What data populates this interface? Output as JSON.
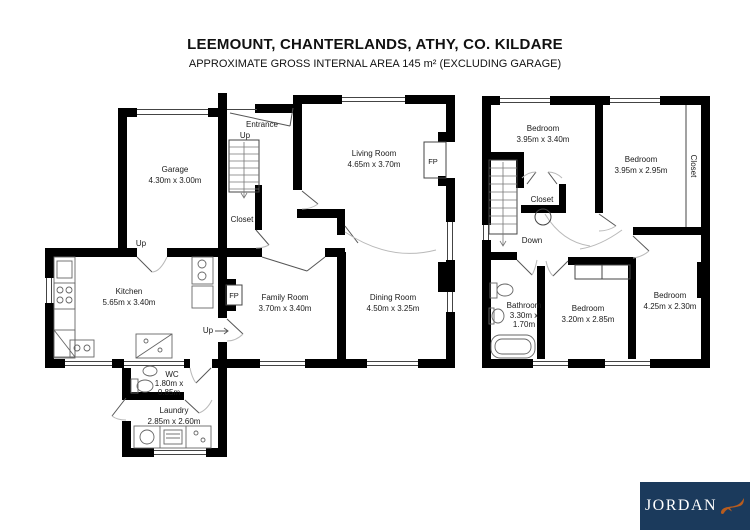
{
  "header": {
    "title": "LEEMOUNT, CHANTERLANDS, ATHY, CO. KILDARE",
    "subtitle": "APPROXIMATE GROSS INTERNAL AREA 145 m² (EXCLUDING GARAGE)"
  },
  "ground_floor": {
    "garage": {
      "name": "Garage",
      "dims": "4.30m x 3.00m"
    },
    "living": {
      "name": "Living Room",
      "dims": "4.65m x 3.70m"
    },
    "kitchen": {
      "name": "Kitchen",
      "dims": "5.65m x 3.40m"
    },
    "family": {
      "name": "Family Room",
      "dims": "3.70m x 3.40m"
    },
    "dining": {
      "name": "Dining Room",
      "dims": "4.50m x 3.25m"
    },
    "wc": {
      "name": "WC",
      "dims_line1": "1.80m x",
      "dims_line2": "0.85m"
    },
    "laundry": {
      "name": "Laundry",
      "dims": "2.85m x 2.60m"
    },
    "entrance_label": "Entrance",
    "up_label": "Up",
    "closet_label": "Closet",
    "fp_label": "FP"
  },
  "first_floor": {
    "bedroom1": {
      "name": "Bedroom",
      "dims": "3.95m x 3.40m"
    },
    "bedroom2": {
      "name": "Bedroom",
      "dims": "3.95m x 2.95m"
    },
    "bedroom3": {
      "name": "Bedroom",
      "dims": "3.20m x 2.85m"
    },
    "bedroom4": {
      "name": "Bedroom",
      "dims": "4.25m x 2.30m"
    },
    "bathroom": {
      "name": "Bathroom",
      "dims_line1": "3.30m x",
      "dims_line2": "1.70m"
    },
    "closet_label": "Closet",
    "closet_right_label": "Closet",
    "down_label": "Down"
  },
  "logo": {
    "brand": "JORDAN",
    "bg_color": "#1b3a5c",
    "fox_color": "#b85c1e"
  }
}
